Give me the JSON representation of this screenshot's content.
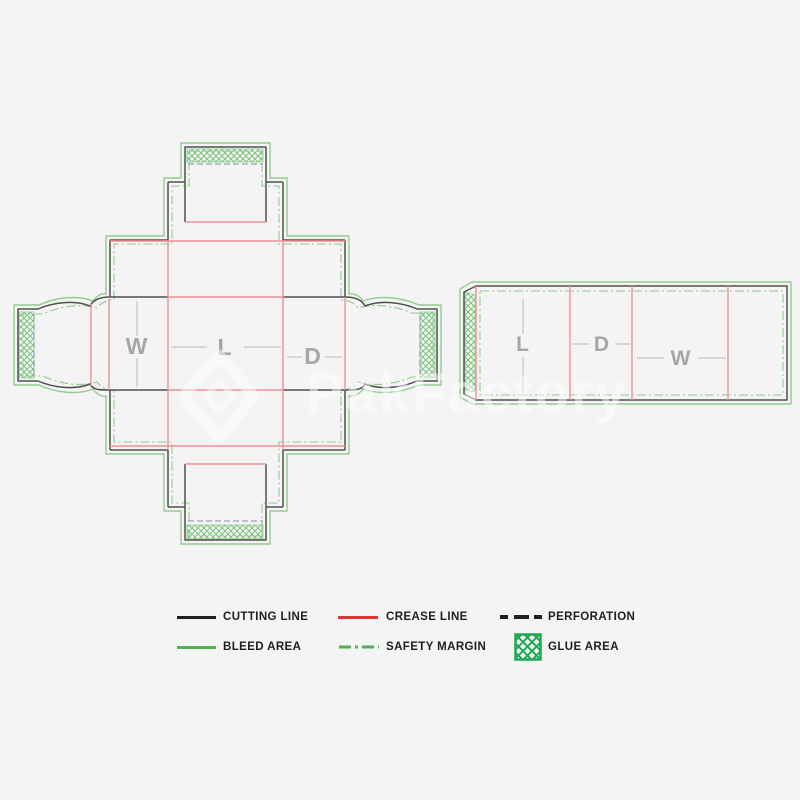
{
  "watermark": {
    "text": "PakFactory"
  },
  "dielines": {
    "cross": {
      "description": "unfolded box blank, cross layout",
      "labels": {
        "width": "W",
        "length": "L",
        "depth": "D"
      }
    },
    "strip": {
      "description": "unfolded box blank, row layout",
      "labels": {
        "length": "L",
        "depth": "D",
        "width": "W"
      }
    }
  },
  "legend": {
    "cutting": {
      "label": "CUTTING LINE"
    },
    "crease": {
      "label": "CREASE LINE"
    },
    "perforation": {
      "label": "PERFORATION"
    },
    "bleed": {
      "label": "BLEED AREA"
    },
    "safety": {
      "label": "SAFETY MARGIN"
    },
    "glue": {
      "label": "GLUE AREA"
    }
  },
  "colors": {
    "page_bg": "#f4f4f4",
    "cutting": "#505050",
    "crease": "#ee9191",
    "bleed": "#94cc8f",
    "safety": "#92ca8f",
    "glue": "#79c47b",
    "perforation": "#96a2bd",
    "dimension": "#b8b8b8",
    "label": "#a6a6a6",
    "legend_black": "#1e1e1e",
    "legend_red": "#e23434",
    "legend_green": "#52b152",
    "legend_glue": "#1ea853"
  }
}
